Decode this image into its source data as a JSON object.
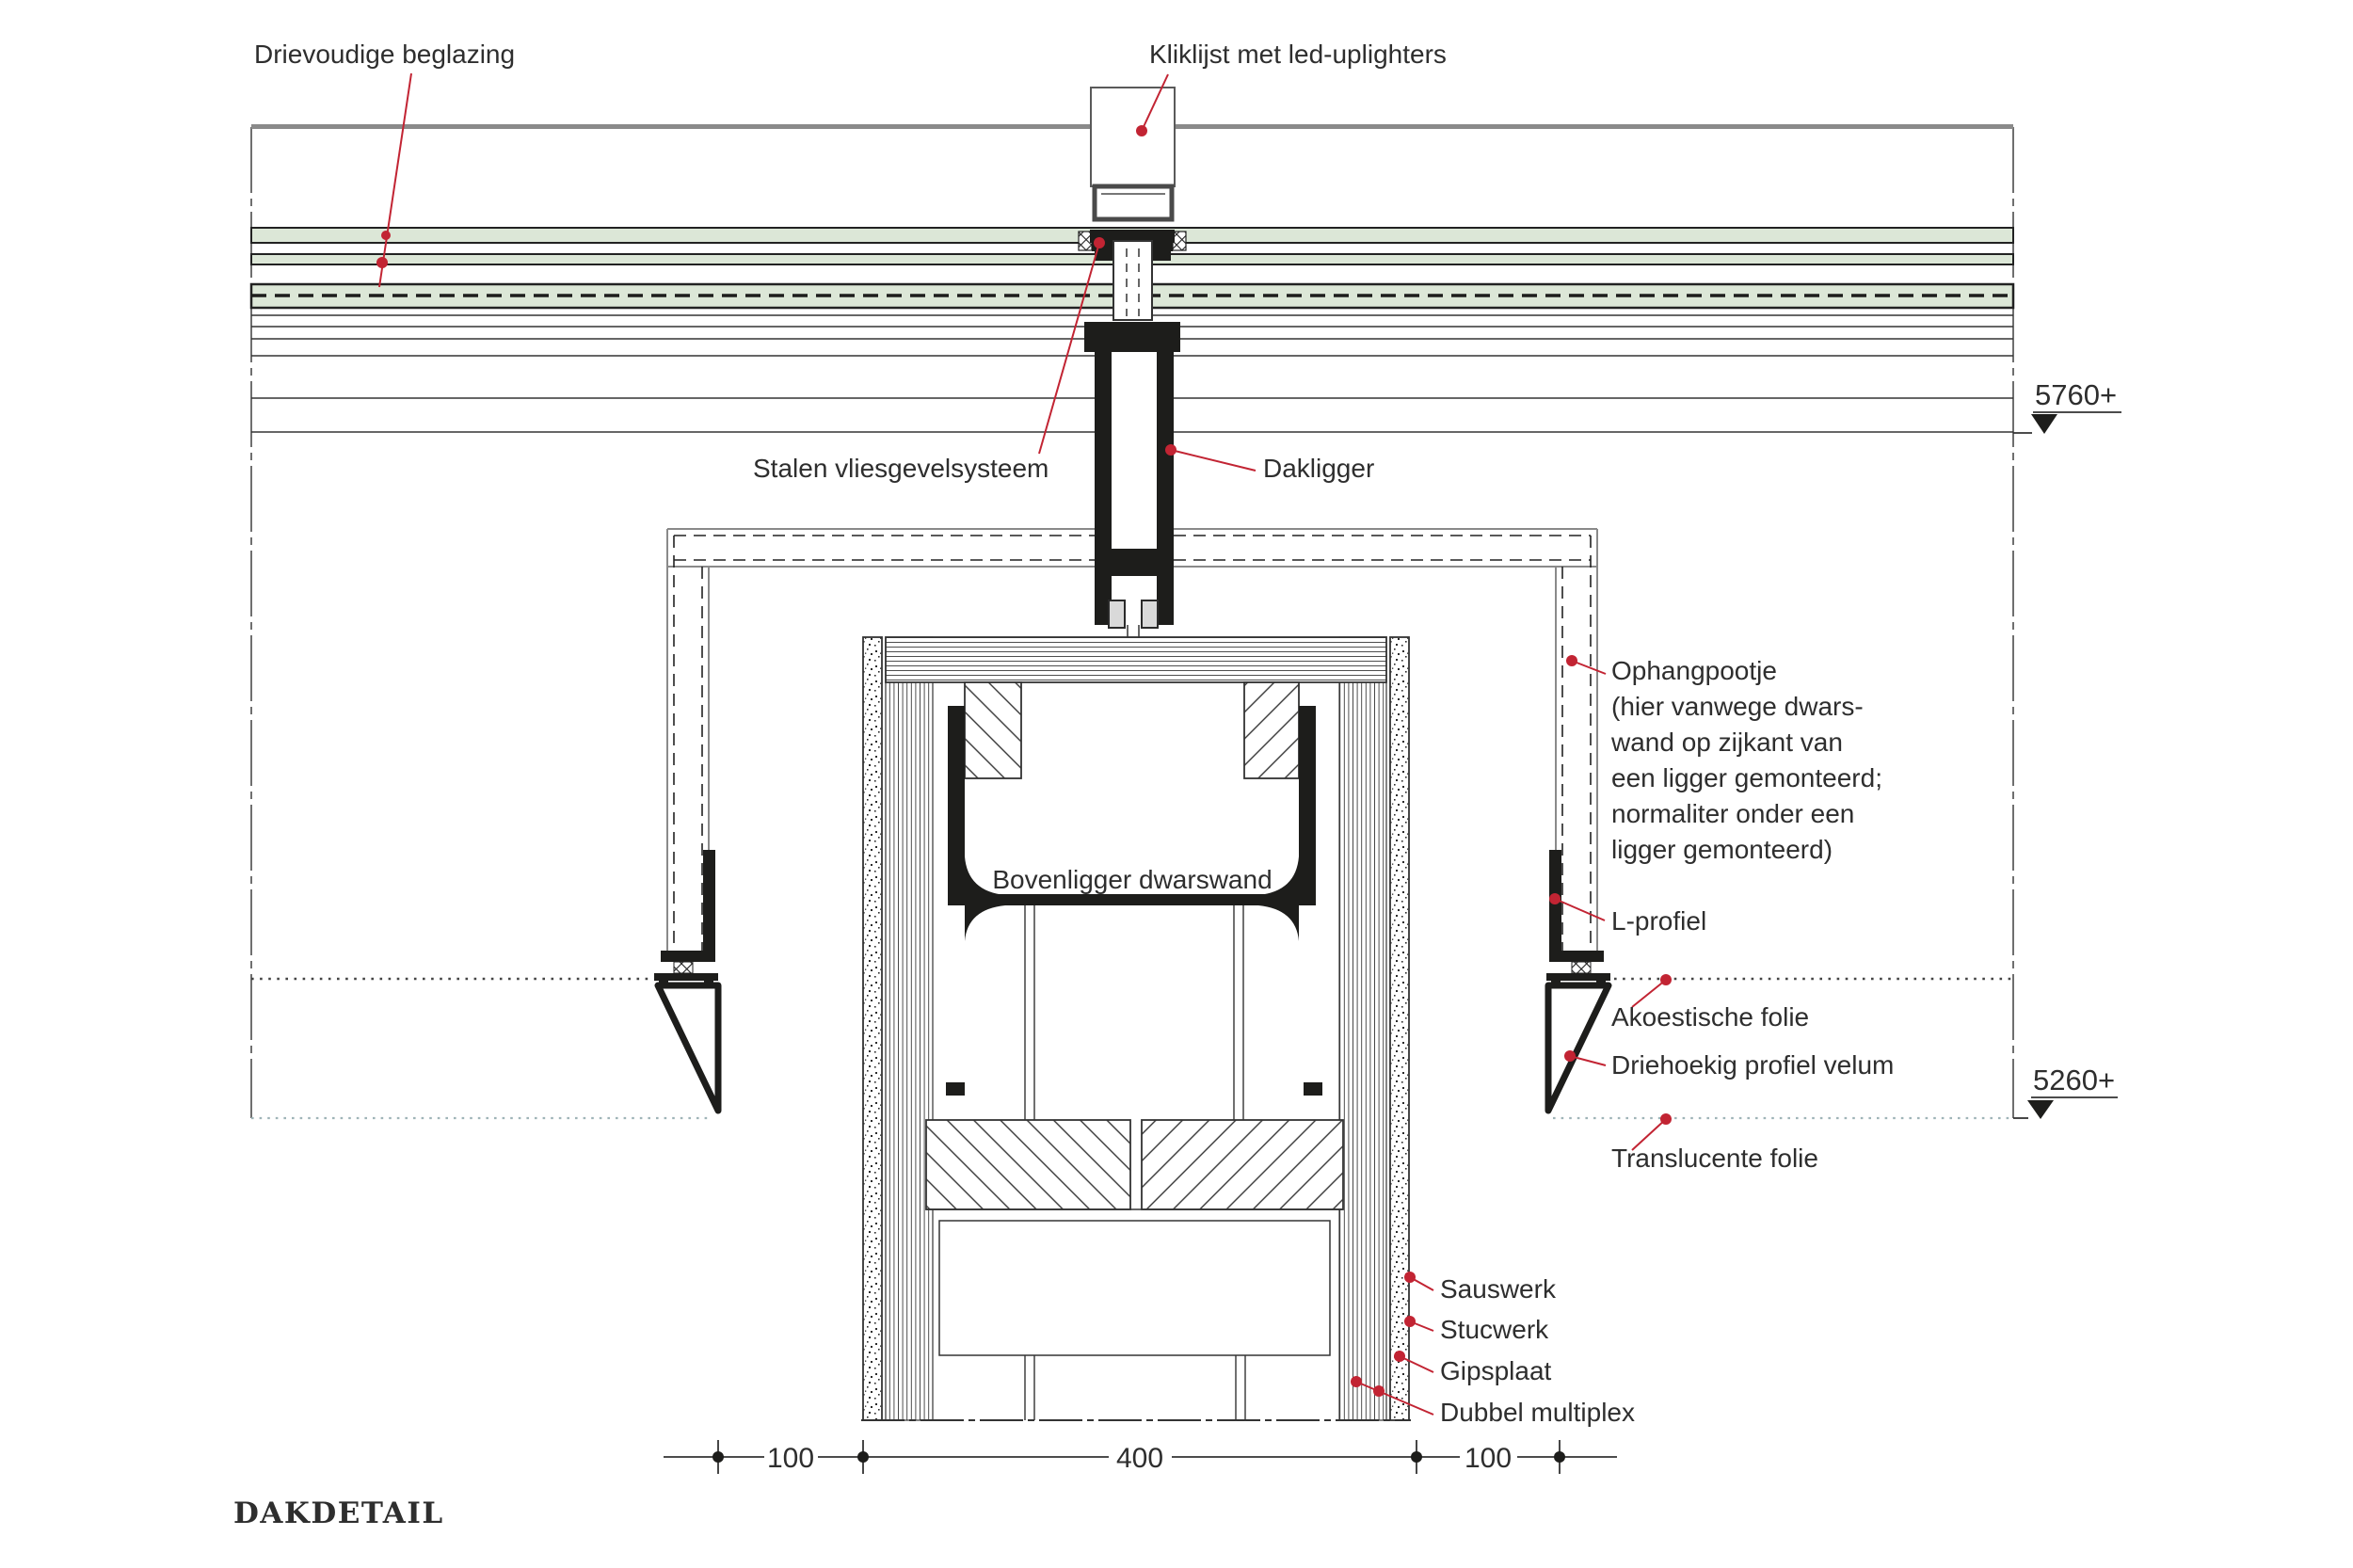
{
  "title": "DAKDETAIL",
  "colors": {
    "accent_red": "#c22433",
    "line": "#333333",
    "glass_green": "#dce7d7",
    "steel_black": "#1d1d1b",
    "gray_line": "#8a8a8a"
  },
  "labels": {
    "drievoudige_beglazing": "Drievoudige beglazing",
    "kliklijst": "Kliklijst met led-uplighters",
    "stalen_vliesgevelsysteem": "Stalen vliesgevelsysteem",
    "dakligger": "Dakligger",
    "ophangpootje_lines": [
      "Ophangpootje",
      "(hier vanwege dwars-",
      "wand op zijkant van",
      "een ligger gemonteerd;",
      "normaliter onder een",
      "ligger gemonteerd)"
    ],
    "bovenligger_dwarswand": "Bovenligger dwarswand",
    "l_profiel": "L-profiel",
    "akoestische_folie": "Akoestische folie",
    "driehoekig_profiel_velum": "Driehoekig profiel velum",
    "translucente_folie": "Translucente folie",
    "sauswerk": "Sauswerk",
    "stucwerk": "Stucwerk",
    "gipsplaat": "Gipsplaat",
    "dubbel_multiplex": "Dubbel multiplex"
  },
  "elevations": {
    "upper": "5760+",
    "lower": "5260+"
  },
  "dimensions": {
    "left": "100",
    "middle": "400",
    "right": "100"
  }
}
